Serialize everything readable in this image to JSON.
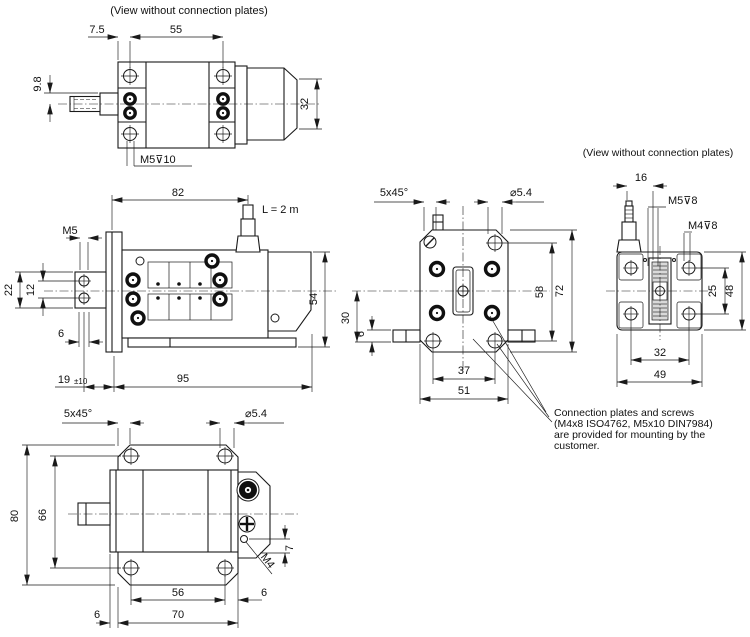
{
  "drawing": {
    "bg_color": "#ffffff",
    "line_color": "#1a1a1a",
    "views": {
      "top_side": {
        "note": "(View without connection plates)",
        "d7_5": "7.5",
        "d55": "55",
        "d9_8": "9.8",
        "d32": "32",
        "thread_m5_depth10": "M5⊽10"
      },
      "front_side": {
        "d82": "82",
        "cable_length": "L = 2 m",
        "thread_m5": "M5",
        "d22": "22",
        "d12": "12",
        "d6": "6",
        "d19": "19",
        "tol19": "±10",
        "d95": "95",
        "d54": "54"
      },
      "bottom_top": {
        "chamfer": "5x45°",
        "hole_dia": "⌀5.4",
        "d80": "80",
        "d66": "66",
        "d7": "7",
        "thread_m4": "M4",
        "d56": "56",
        "d6_right": "6",
        "d6_left": "6",
        "d70": "70"
      },
      "face": {
        "chamfer": "5x45°",
        "hole_dia": "⌀5.4",
        "d30": "30",
        "d6": "6",
        "d37": "37",
        "d51": "51",
        "d58": "58",
        "d72": "72"
      },
      "end": {
        "note": "(View without connection plates)",
        "d16": "16",
        "thread_m5_depth8": "M5⊽8",
        "thread_m4_depth8": "M4⊽8",
        "d25": "25",
        "d48": "48",
        "d32": "32",
        "d49": "49"
      }
    },
    "mounting_note": {
      "line1": "Connection plates and screws",
      "line2": "(M4x8  ISO4762, M5x10 DIN7984)",
      "line3": "are provided for mounting by the",
      "line4": "customer."
    }
  }
}
